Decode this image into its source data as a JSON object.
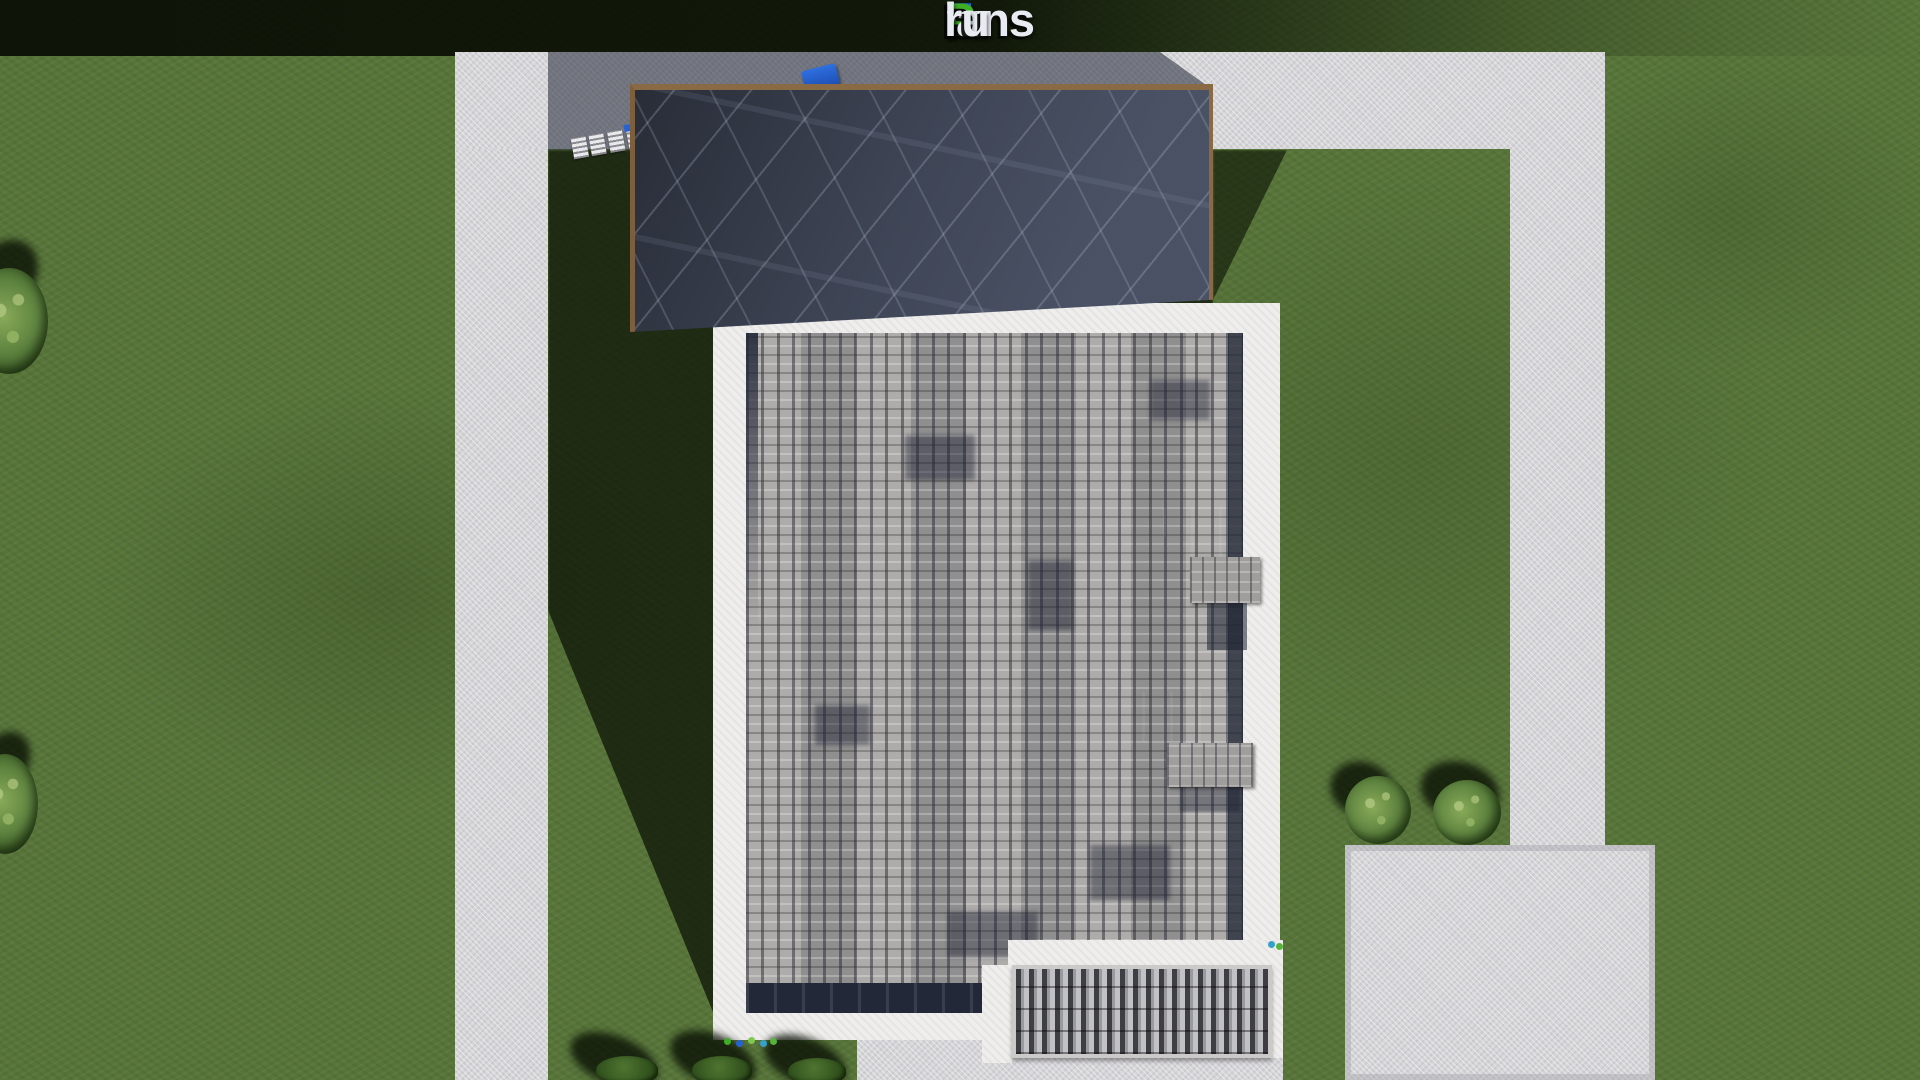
{
  "logo": {
    "text": "FixPlans.ru",
    "parts": [
      {
        "text": "F",
        "color": "#1f66d6"
      },
      {
        "text": "ix",
        "color": "#e9ebf3"
      },
      {
        "text": "P",
        "color": "#3fae27"
      },
      {
        "text": "lans",
        "color": "#e9ebf3"
      },
      {
        "text": ".",
        "color": "#1f66d6"
      },
      {
        "text": "ru",
        "color": "#e9ebf3"
      }
    ]
  },
  "scene": {
    "description": "aerial top-down 3D render of a house plot",
    "lawn": {
      "label": "green lawn",
      "color": "#577539"
    },
    "walkway": {
      "label": "concrete walkway frame",
      "color": "#d6d5d8"
    },
    "driveway_pad": {
      "label": "concrete pads",
      "color": "#d6d5d8"
    },
    "garage_roof": {
      "label": "dark membrane roof with wood trim",
      "color": "#414859",
      "trim_color": "#8a6a45"
    },
    "house_roof": {
      "label": "grey shingle flat roof with white parapet",
      "parapet_color": "#efeeec",
      "shingle_color": "#a8a6a4",
      "edge_shadow_color": "#232839"
    },
    "skylights": {
      "label": "roof skylights and vent boxes",
      "glass_color": "#202634",
      "vent_color": "#a09e9c"
    },
    "canopy": {
      "label": "slatted terrace canopy",
      "slat_dark": "#3e3e45",
      "slat_light": "#c2c1c5"
    },
    "vegetation": {
      "label": "trees and bushes",
      "foliage_color": "#5f8440",
      "shadow_color": "#0a0e03"
    },
    "car": {
      "label": "blue object on driveway",
      "color": "#2563d4"
    },
    "shadows": {
      "label": "long cast shadows",
      "color": "#0c1205"
    }
  }
}
